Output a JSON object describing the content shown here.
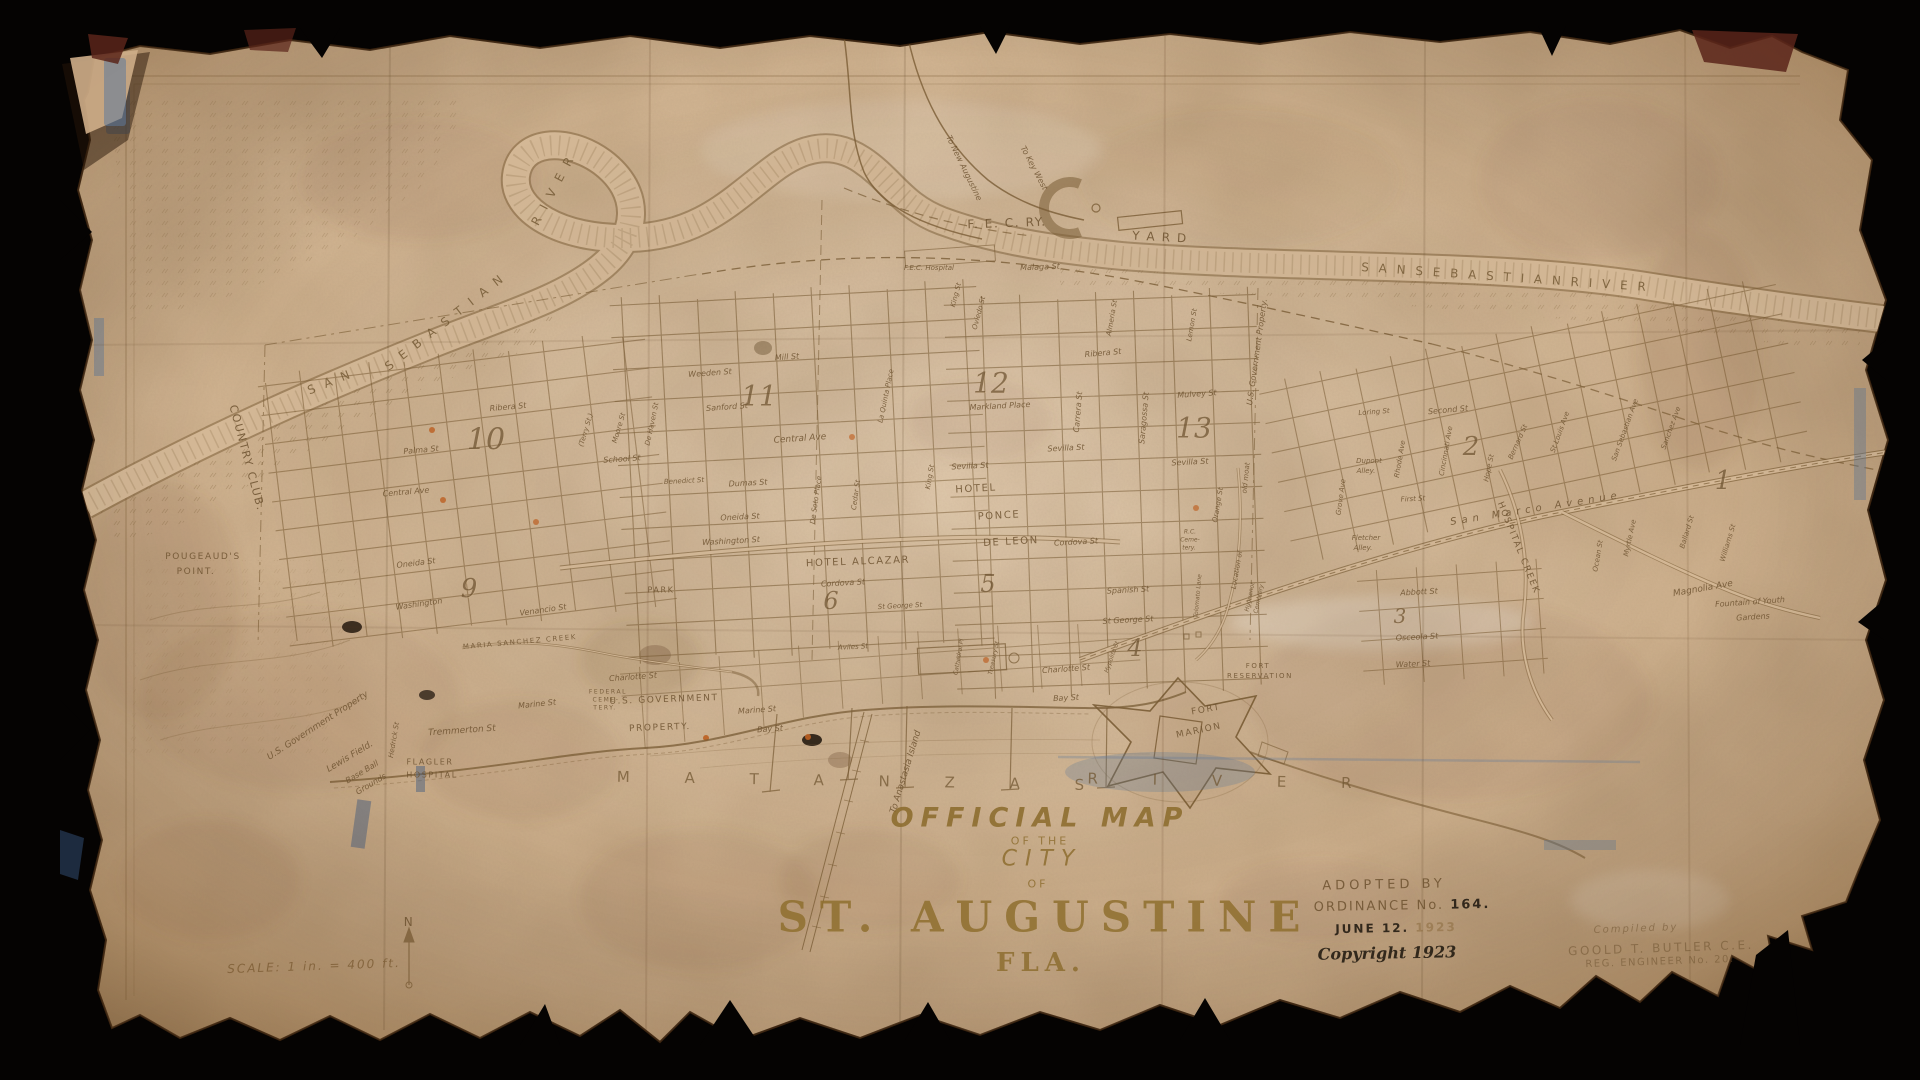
{
  "window": {
    "background": "#050302"
  },
  "paper": {
    "color": "#d4b896",
    "ink": "#7a5c34"
  },
  "title_block": {
    "official_map": "OFFICIAL MAP",
    "of_the": "OF THE",
    "city": "CITY",
    "of": "OF",
    "st_augustine": "ST. AUGUSTINE",
    "fla": "FLA."
  },
  "adoption": {
    "adopted_by": "ADOPTED BY",
    "ordinance": "ORDINANCE No.",
    "ordinance_no": "164.",
    "june": "JUNE 12.",
    "year": "1923",
    "copyright": "Copyright 1923"
  },
  "compiler": {
    "compiled_by": "Compiled by",
    "name": "GOOLD T. BUTLER C.E.",
    "reg": "REG. ENGINEER No. 20."
  },
  "scale_note": "SCALE: 1 in. = 400 ft.",
  "map": {
    "labels": [
      {
        "t": "S A N",
        "x": 330,
        "y": 382,
        "r": -22,
        "s": 12,
        "c": "water"
      },
      {
        "t": "S E B A S T I A N",
        "x": 445,
        "y": 322,
        "r": -38,
        "s": 12,
        "c": "water"
      },
      {
        "t": "R I V E R",
        "x": 553,
        "y": 190,
        "r": -62,
        "s": 12,
        "c": "water"
      },
      {
        "t": "S A N   S E B A S T I A N   R I V E R",
        "x": 1505,
        "y": 277,
        "r": 4,
        "s": 12,
        "c": "water"
      },
      {
        "t": "M A T A N Z A S",
        "x": 863,
        "y": 781,
        "r": 1,
        "s": 15,
        "c": "water2"
      },
      {
        "t": "R I V E R",
        "x": 1232,
        "y": 781,
        "r": 1,
        "s": 15,
        "c": "water2"
      },
      {
        "t": "MARIA  SANCHEZ  CREEK",
        "x": 520,
        "y": 642,
        "r": -5,
        "s": 7,
        "c": "caps"
      },
      {
        "t": "HOSPITAL  CREEK",
        "x": 1518,
        "y": 548,
        "r": 68,
        "s": 9,
        "c": "caps"
      },
      {
        "t": "To Anastasia Island",
        "x": 906,
        "y": 772,
        "r": -73,
        "s": 9
      },
      {
        "t": "F. E. C.  RY.",
        "x": 1007,
        "y": 223,
        "r": -2,
        "s": 12,
        "c": "caps"
      },
      {
        "t": "Y A R D",
        "x": 1160,
        "y": 237,
        "r": 3,
        "s": 12,
        "c": "caps"
      },
      {
        "t": "To Key West",
        "x": 1034,
        "y": 168,
        "r": 62,
        "s": 8
      },
      {
        "t": "To New Augustine",
        "x": 964,
        "y": 168,
        "r": 64,
        "s": 8
      },
      {
        "t": "F.E.C. Hospital",
        "x": 929,
        "y": 268,
        "r": 0,
        "s": 7
      },
      {
        "t": "Malaga St",
        "x": 1040,
        "y": 267,
        "r": -2,
        "s": 8
      },
      {
        "t": "COUNTRY CLUB.",
        "x": 247,
        "y": 458,
        "r": 75,
        "s": 11,
        "c": "caps"
      },
      {
        "t": "POUGEAUD'S",
        "x": 203,
        "y": 557,
        "r": 0,
        "s": 9,
        "c": "caps"
      },
      {
        "t": "POINT.",
        "x": 196,
        "y": 572,
        "r": 0,
        "s": 9,
        "c": "caps"
      },
      {
        "t": "U.S. Government Property",
        "x": 318,
        "y": 726,
        "r": -33,
        "s": 9
      },
      {
        "t": "Lewis Field.",
        "x": 350,
        "y": 757,
        "r": -31,
        "s": 9
      },
      {
        "t": "Base Ball",
        "x": 362,
        "y": 772,
        "r": -31,
        "s": 8
      },
      {
        "t": "Grounds",
        "x": 371,
        "y": 784,
        "r": -31,
        "s": 8
      },
      {
        "t": "FLAGLER",
        "x": 430,
        "y": 762,
        "r": 0,
        "s": 8,
        "c": "caps"
      },
      {
        "t": "HOSPITAL",
        "x": 432,
        "y": 775,
        "r": 0,
        "s": 8,
        "c": "caps"
      },
      {
        "t": "Tremmerton St",
        "x": 462,
        "y": 731,
        "r": -4,
        "s": 9
      },
      {
        "t": "Hedrick St",
        "x": 394,
        "y": 740,
        "r": -80,
        "s": 7
      },
      {
        "t": "Venancio St",
        "x": 543,
        "y": 610,
        "r": -8,
        "s": 8
      },
      {
        "t": "Washington",
        "x": 419,
        "y": 604,
        "r": -8,
        "s": 8
      },
      {
        "t": "Oneida St",
        "x": 416,
        "y": 563,
        "r": -7,
        "s": 8
      },
      {
        "t": "Central Ave",
        "x": 406,
        "y": 492,
        "r": -5,
        "s": 8
      },
      {
        "t": "Palma St",
        "x": 421,
        "y": 450,
        "r": -5,
        "s": 8
      },
      {
        "t": "Ribera St",
        "x": 508,
        "y": 407,
        "r": -5,
        "s": 8
      },
      {
        "t": "10",
        "x": 486,
        "y": 440,
        "r": 0,
        "s": 30,
        "c": "num"
      },
      {
        "t": "11",
        "x": 759,
        "y": 396,
        "r": 0,
        "s": 28,
        "c": "num"
      },
      {
        "t": "12",
        "x": 991,
        "y": 383,
        "r": 0,
        "s": 28,
        "c": "num"
      },
      {
        "t": "13",
        "x": 1194,
        "y": 428,
        "r": 0,
        "s": 28,
        "c": "num"
      },
      {
        "t": "9",
        "x": 469,
        "y": 589,
        "r": 0,
        "s": 26,
        "c": "num"
      },
      {
        "t": "6",
        "x": 831,
        "y": 601,
        "r": 0,
        "s": 24,
        "c": "num"
      },
      {
        "t": "5",
        "x": 988,
        "y": 584,
        "r": 0,
        "s": 24,
        "c": "num"
      },
      {
        "t": "4",
        "x": 1135,
        "y": 648,
        "r": 0,
        "s": 24,
        "c": "num"
      },
      {
        "t": "3",
        "x": 1400,
        "y": 616,
        "r": 0,
        "s": 20,
        "c": "num"
      },
      {
        "t": "2",
        "x": 1471,
        "y": 447,
        "r": 0,
        "s": 26,
        "c": "num"
      },
      {
        "t": "1",
        "x": 1723,
        "y": 481,
        "r": 0,
        "s": 26,
        "c": "num"
      },
      {
        "t": "Weeden St",
        "x": 710,
        "y": 373,
        "r": -4,
        "s": 8
      },
      {
        "t": "Mill St",
        "x": 787,
        "y": 357,
        "r": -4,
        "s": 8
      },
      {
        "t": "Sanford St",
        "x": 727,
        "y": 407,
        "r": -4,
        "s": 8
      },
      {
        "t": "Central Ave",
        "x": 800,
        "y": 439,
        "r": -4,
        "s": 9
      },
      {
        "t": "School St",
        "x": 622,
        "y": 459,
        "r": -4,
        "s": 8
      },
      {
        "t": "Benedict St",
        "x": 684,
        "y": 481,
        "r": -3,
        "s": 7
      },
      {
        "t": "Dumas St",
        "x": 748,
        "y": 483,
        "r": -3,
        "s": 8
      },
      {
        "t": "Oneida St",
        "x": 740,
        "y": 517,
        "r": -3,
        "s": 8
      },
      {
        "t": "Washington St",
        "x": 731,
        "y": 541,
        "r": -3,
        "s": 8
      },
      {
        "t": "(Terry St.)",
        "x": 586,
        "y": 430,
        "r": -73,
        "s": 7
      },
      {
        "t": "Moore St",
        "x": 619,
        "y": 428,
        "r": -73,
        "s": 7
      },
      {
        "t": "De Haven St",
        "x": 652,
        "y": 424,
        "r": -78,
        "s": 7
      },
      {
        "t": "De Soto Place",
        "x": 816,
        "y": 500,
        "r": -82,
        "s": 7
      },
      {
        "t": "Cedar St",
        "x": 856,
        "y": 495,
        "r": -82,
        "s": 7
      },
      {
        "t": "La Quinta Place",
        "x": 886,
        "y": 396,
        "r": -78,
        "s": 7
      },
      {
        "t": "King St",
        "x": 930,
        "y": 477,
        "r": -80,
        "s": 7
      },
      {
        "t": "PARK",
        "x": 661,
        "y": 590,
        "r": 0,
        "s": 8,
        "c": "caps"
      },
      {
        "t": "HOTEL  ALCAZAR",
        "x": 858,
        "y": 562,
        "r": -2,
        "s": 10,
        "c": "caps"
      },
      {
        "t": "HOTEL",
        "x": 976,
        "y": 489,
        "r": -3,
        "s": 10,
        "c": "caps"
      },
      {
        "t": "PONCE",
        "x": 999,
        "y": 516,
        "r": -3,
        "s": 10,
        "c": "caps"
      },
      {
        "t": "DE LEON",
        "x": 1011,
        "y": 542,
        "r": -3,
        "s": 10,
        "c": "caps"
      },
      {
        "t": "Cordova St",
        "x": 843,
        "y": 583,
        "r": -3,
        "s": 8
      },
      {
        "t": "Cordova St",
        "x": 1076,
        "y": 542,
        "r": -3,
        "s": 8
      },
      {
        "t": "King St",
        "x": 956,
        "y": 295,
        "r": -75,
        "s": 7
      },
      {
        "t": "Oviedo St",
        "x": 979,
        "y": 313,
        "r": -75,
        "s": 7
      },
      {
        "t": "Ribera St",
        "x": 1103,
        "y": 353,
        "r": -5,
        "s": 8
      },
      {
        "t": "Almeria St",
        "x": 1112,
        "y": 318,
        "r": -80,
        "s": 7
      },
      {
        "t": "Lemon St",
        "x": 1192,
        "y": 325,
        "r": -80,
        "s": 7
      },
      {
        "t": "Sevilla St",
        "x": 970,
        "y": 466,
        "r": -3,
        "s": 8
      },
      {
        "t": "Sevilla St",
        "x": 1066,
        "y": 448,
        "r": -3,
        "s": 8
      },
      {
        "t": "Sevilla St",
        "x": 1190,
        "y": 462,
        "r": -3,
        "s": 8
      },
      {
        "t": "Carrera St",
        "x": 1078,
        "y": 412,
        "r": -85,
        "s": 8
      },
      {
        "t": "Saragossa St",
        "x": 1144,
        "y": 418,
        "r": -85,
        "s": 8
      },
      {
        "t": "Markland Place",
        "x": 1000,
        "y": 406,
        "r": -3,
        "s": 8
      },
      {
        "t": "Mulvey St",
        "x": 1197,
        "y": 394,
        "r": -4,
        "s": 8
      },
      {
        "t": "U.S. Government Property.",
        "x": 1257,
        "y": 352,
        "r": -82,
        "s": 8
      },
      {
        "t": "old moat",
        "x": 1246,
        "y": 478,
        "r": -84,
        "s": 7
      },
      {
        "t": "Location of",
        "x": 1237,
        "y": 570,
        "r": -80,
        "s": 7
      },
      {
        "t": "Orange St",
        "x": 1218,
        "y": 505,
        "r": -80,
        "s": 7
      },
      {
        "t": "R.C.",
        "x": 1190,
        "y": 532,
        "r": 0,
        "s": 6
      },
      {
        "t": "Ceme-",
        "x": 1190,
        "y": 540,
        "r": 0,
        "s": 6
      },
      {
        "t": "tery.",
        "x": 1189,
        "y": 548,
        "r": 0,
        "s": 6
      },
      {
        "t": "Huguenot",
        "x": 1250,
        "y": 597,
        "r": -78,
        "s": 6
      },
      {
        "t": "Cemetery",
        "x": 1259,
        "y": 599,
        "r": -78,
        "s": 6
      },
      {
        "t": "Tolomato Lane",
        "x": 1198,
        "y": 596,
        "r": -85,
        "s": 6
      },
      {
        "t": "Spanish St",
        "x": 1128,
        "y": 590,
        "r": -3,
        "s": 8
      },
      {
        "t": "St George St",
        "x": 1128,
        "y": 620,
        "r": -3,
        "s": 8
      },
      {
        "t": "St George St",
        "x": 900,
        "y": 606,
        "r": -3,
        "s": 7
      },
      {
        "t": "Charlotte St",
        "x": 1066,
        "y": 669,
        "r": -4,
        "s": 8
      },
      {
        "t": "Charlotte St",
        "x": 633,
        "y": 677,
        "r": -4,
        "s": 8
      },
      {
        "t": "Aviles St",
        "x": 853,
        "y": 647,
        "r": -3,
        "s": 7
      },
      {
        "t": "Treasury St",
        "x": 994,
        "y": 658,
        "r": -78,
        "s": 6
      },
      {
        "t": "Hypolita St",
        "x": 1112,
        "y": 657,
        "r": -70,
        "s": 6
      },
      {
        "t": "Cathedral Pl",
        "x": 959,
        "y": 657,
        "r": -80,
        "s": 6
      },
      {
        "t": "Marine St",
        "x": 757,
        "y": 710,
        "r": -4,
        "s": 8
      },
      {
        "t": "Bay St",
        "x": 770,
        "y": 729,
        "r": -4,
        "s": 8
      },
      {
        "t": "Marine St",
        "x": 537,
        "y": 704,
        "r": -6,
        "s": 8
      },
      {
        "t": "Bay St",
        "x": 1066,
        "y": 698,
        "r": -3,
        "s": 8
      },
      {
        "t": "U.S. GOVERNMENT",
        "x": 664,
        "y": 700,
        "r": -2,
        "s": 9,
        "c": "caps"
      },
      {
        "t": "PROPERTY.",
        "x": 660,
        "y": 728,
        "r": -2,
        "s": 9,
        "c": "caps"
      },
      {
        "t": "FEDERAL",
        "x": 608,
        "y": 692,
        "r": 0,
        "s": 6,
        "c": "caps"
      },
      {
        "t": "CEME-",
        "x": 606,
        "y": 700,
        "r": 0,
        "s": 6,
        "c": "caps"
      },
      {
        "t": "TERY.",
        "x": 605,
        "y": 708,
        "r": 0,
        "s": 6,
        "c": "caps"
      },
      {
        "t": "FORT",
        "x": 1206,
        "y": 710,
        "r": -10,
        "s": 9,
        "c": "caps"
      },
      {
        "t": "MARION",
        "x": 1199,
        "y": 731,
        "r": -12,
        "s": 9,
        "c": "caps"
      },
      {
        "t": "FORT",
        "x": 1258,
        "y": 666,
        "r": 0,
        "s": 7,
        "c": "caps"
      },
      {
        "t": "RESERVATION",
        "x": 1260,
        "y": 676,
        "r": 0,
        "s": 7,
        "c": "caps"
      },
      {
        "t": "Grove Ave",
        "x": 1341,
        "y": 497,
        "r": -82,
        "s": 7
      },
      {
        "t": "Dupont",
        "x": 1369,
        "y": 461,
        "r": 0,
        "s": 7
      },
      {
        "t": "Alley.",
        "x": 1366,
        "y": 471,
        "r": 0,
        "s": 7
      },
      {
        "t": "Fletcher",
        "x": 1366,
        "y": 538,
        "r": 0,
        "s": 7
      },
      {
        "t": "Alley.",
        "x": 1363,
        "y": 548,
        "r": 0,
        "s": 7
      },
      {
        "t": "First St",
        "x": 1413,
        "y": 499,
        "r": -3,
        "s": 7
      },
      {
        "t": "Rhode Ave",
        "x": 1400,
        "y": 459,
        "r": -80,
        "s": 7
      },
      {
        "t": "Cincinnati Ave",
        "x": 1446,
        "y": 451,
        "r": -80,
        "s": 7
      },
      {
        "t": "Second St",
        "x": 1448,
        "y": 410,
        "r": -5,
        "s": 8
      },
      {
        "t": "Loring St",
        "x": 1374,
        "y": 412,
        "r": -4,
        "s": 7
      },
      {
        "t": "Hope St",
        "x": 1489,
        "y": 468,
        "r": -78,
        "s": 7
      },
      {
        "t": "Bernard St",
        "x": 1518,
        "y": 442,
        "r": -66,
        "s": 7
      },
      {
        "t": "St Louis Ave",
        "x": 1560,
        "y": 432,
        "r": -70,
        "s": 7
      },
      {
        "t": "San  Marco  Avenue",
        "x": 1536,
        "y": 509,
        "r": -9,
        "s": 10,
        "c": "road"
      },
      {
        "t": "San Sebastian Ave",
        "x": 1625,
        "y": 430,
        "r": -70,
        "s": 7
      },
      {
        "t": "Myrtle Ave",
        "x": 1630,
        "y": 538,
        "r": -78,
        "s": 7
      },
      {
        "t": "Sanchez Ave",
        "x": 1671,
        "y": 428,
        "r": -70,
        "s": 7
      },
      {
        "t": "Ocean St",
        "x": 1598,
        "y": 556,
        "r": -80,
        "s": 7
      },
      {
        "t": "Ballard St",
        "x": 1687,
        "y": 532,
        "r": -73,
        "s": 7
      },
      {
        "t": "Williams St",
        "x": 1728,
        "y": 543,
        "r": -73,
        "s": 7
      },
      {
        "t": "Magnolia Ave",
        "x": 1703,
        "y": 589,
        "r": -10,
        "s": 9
      },
      {
        "t": "Fountain of Youth",
        "x": 1750,
        "y": 602,
        "r": -4,
        "s": 8
      },
      {
        "t": "Gardens",
        "x": 1753,
        "y": 617,
        "r": -4,
        "s": 8
      },
      {
        "t": "Abbott St",
        "x": 1419,
        "y": 592,
        "r": -3,
        "s": 8
      },
      {
        "t": "Osceola St",
        "x": 1417,
        "y": 637,
        "r": -3,
        "s": 8
      },
      {
        "t": "Water St",
        "x": 1413,
        "y": 664,
        "r": -3,
        "s": 8
      },
      {
        "t": "N",
        "x": 409,
        "y": 922,
        "r": 0,
        "s": 12,
        "c": "caps"
      }
    ]
  }
}
